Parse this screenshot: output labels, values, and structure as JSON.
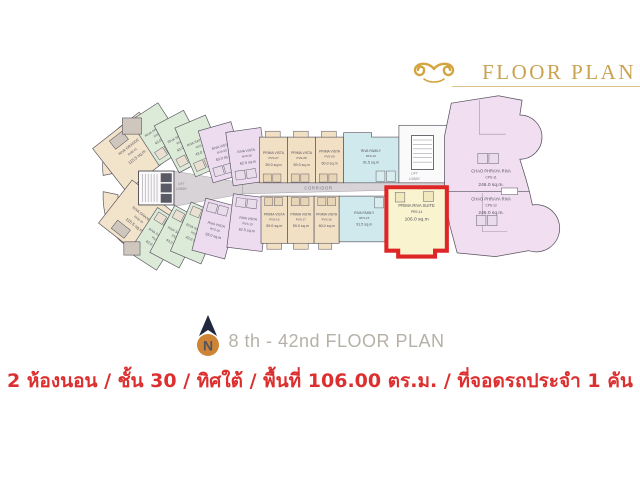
{
  "header": {
    "title": "FLOOR PLAN"
  },
  "caption": {
    "compass_letter": "N",
    "text": "8 th - 42nd FLOOR PLAN"
  },
  "footer": {
    "text": "2 ห้องนอน / ชั้น 30 / ทิศใต้ / พื้นที่ 106.00 ตร.ม. / ที่จอดรถประจำ 1 คัน"
  },
  "plan": {
    "corridor_label": "CORRIDOR",
    "lift_lobby_left": {
      "lines": [
        "LIFT",
        "LOBBY"
      ]
    },
    "lift_lobby_right": {
      "lines": [
        "LIFT",
        "LOBBY"
      ]
    },
    "units": [
      {
        "name": "RIVA GRANDE",
        "code": "RGB-01",
        "area": "115.5 sq.m"
      },
      {
        "name": "RIVA SATHORN",
        "code": "RSS-02",
        "area": "43.0 sq.m"
      },
      {
        "name": "RIVA SATHORN",
        "code": "RSS-03",
        "area": "43.0 sq.m"
      },
      {
        "name": "RIVA SATHORN",
        "code": "RSS-04",
        "area": "43.0 sq.m"
      },
      {
        "name": "RIVA VISTA",
        "code": "RVS-05",
        "area": "63.0 sq.m"
      },
      {
        "name": "RIVA VISTA",
        "code": "RVS-06",
        "area": "62.5 sq.m"
      },
      {
        "name": "PRIMA VISTA",
        "code": "PVS-07",
        "area": "59.0 sq.m"
      },
      {
        "name": "PRIMA VISTA",
        "code": "PVS-08",
        "area": "59.0 sq.m"
      },
      {
        "name": "PRIMA VISTA",
        "code": "PVS-09",
        "area": "60.0 sq.m"
      },
      {
        "name": "RIVA FAMILY",
        "code": "RFS-10",
        "area": "91.5 sq.m"
      },
      {
        "name": "CHAO PHRAYA RIVA",
        "code": "CPS-11",
        "area": "246.0 sq.m."
      },
      {
        "name": "CHAO PHRAYA RIVA",
        "code": "CPS-12",
        "area": "246.0 sq.m."
      },
      {
        "name": "PRIMA RIVA SUITE",
        "code": "PRS-14",
        "area": "106.0 sq.m",
        "highlighted": true
      },
      {
        "name": "RIVA FAMILY",
        "code": "RFS-15",
        "area": "91.5 sq.m"
      },
      {
        "name": "PRIMA VISTA",
        "code": "PVS-16",
        "area": "60.0 sq.m"
      },
      {
        "name": "PRIMA VISTA",
        "code": "PVS-17",
        "area": "59.0 sq.m"
      },
      {
        "name": "PRIMA VISTA",
        "code": "PVS-18",
        "area": "59.0 sq.m"
      },
      {
        "name": "RIVA VISTA",
        "code": "RVS-19",
        "area": "62.5 sq.m"
      },
      {
        "name": "RIVA VISTA",
        "code": "RVS-20",
        "area": "63.0 sq.m"
      },
      {
        "name": "RIVA SATHORN",
        "code": "RSS-21",
        "area": "43.0 sq.m"
      },
      {
        "name": "RIVA SATHORN",
        "code": "RSS-22",
        "area": "43.0 sq.m"
      },
      {
        "name": "RIVA SATHORN",
        "code": "RSS-23",
        "area": "43.0 sq.m"
      },
      {
        "name": "RIVA GRANDE",
        "code": "RGB-24",
        "area": "115.5 sq.m"
      }
    ]
  },
  "palette": {
    "gold": "#c9a352",
    "caption_gray": "#b5b1a8",
    "footer_red": "#dc2f2f",
    "highlight_border_red": "#de2626",
    "unit_peach": "#f2e3cb",
    "unit_green": "#dcebd7",
    "unit_lavender": "#eddcf0",
    "unit_tan": "#f2e0c4",
    "unit_cyan": "#cfe9ec",
    "unit_pink": "#f2def1",
    "unit_yellow": "#f9f3cf",
    "corridor_gray": "#d8d3d6",
    "compass_orange": "#cd8434",
    "compass_navy": "#202840"
  }
}
